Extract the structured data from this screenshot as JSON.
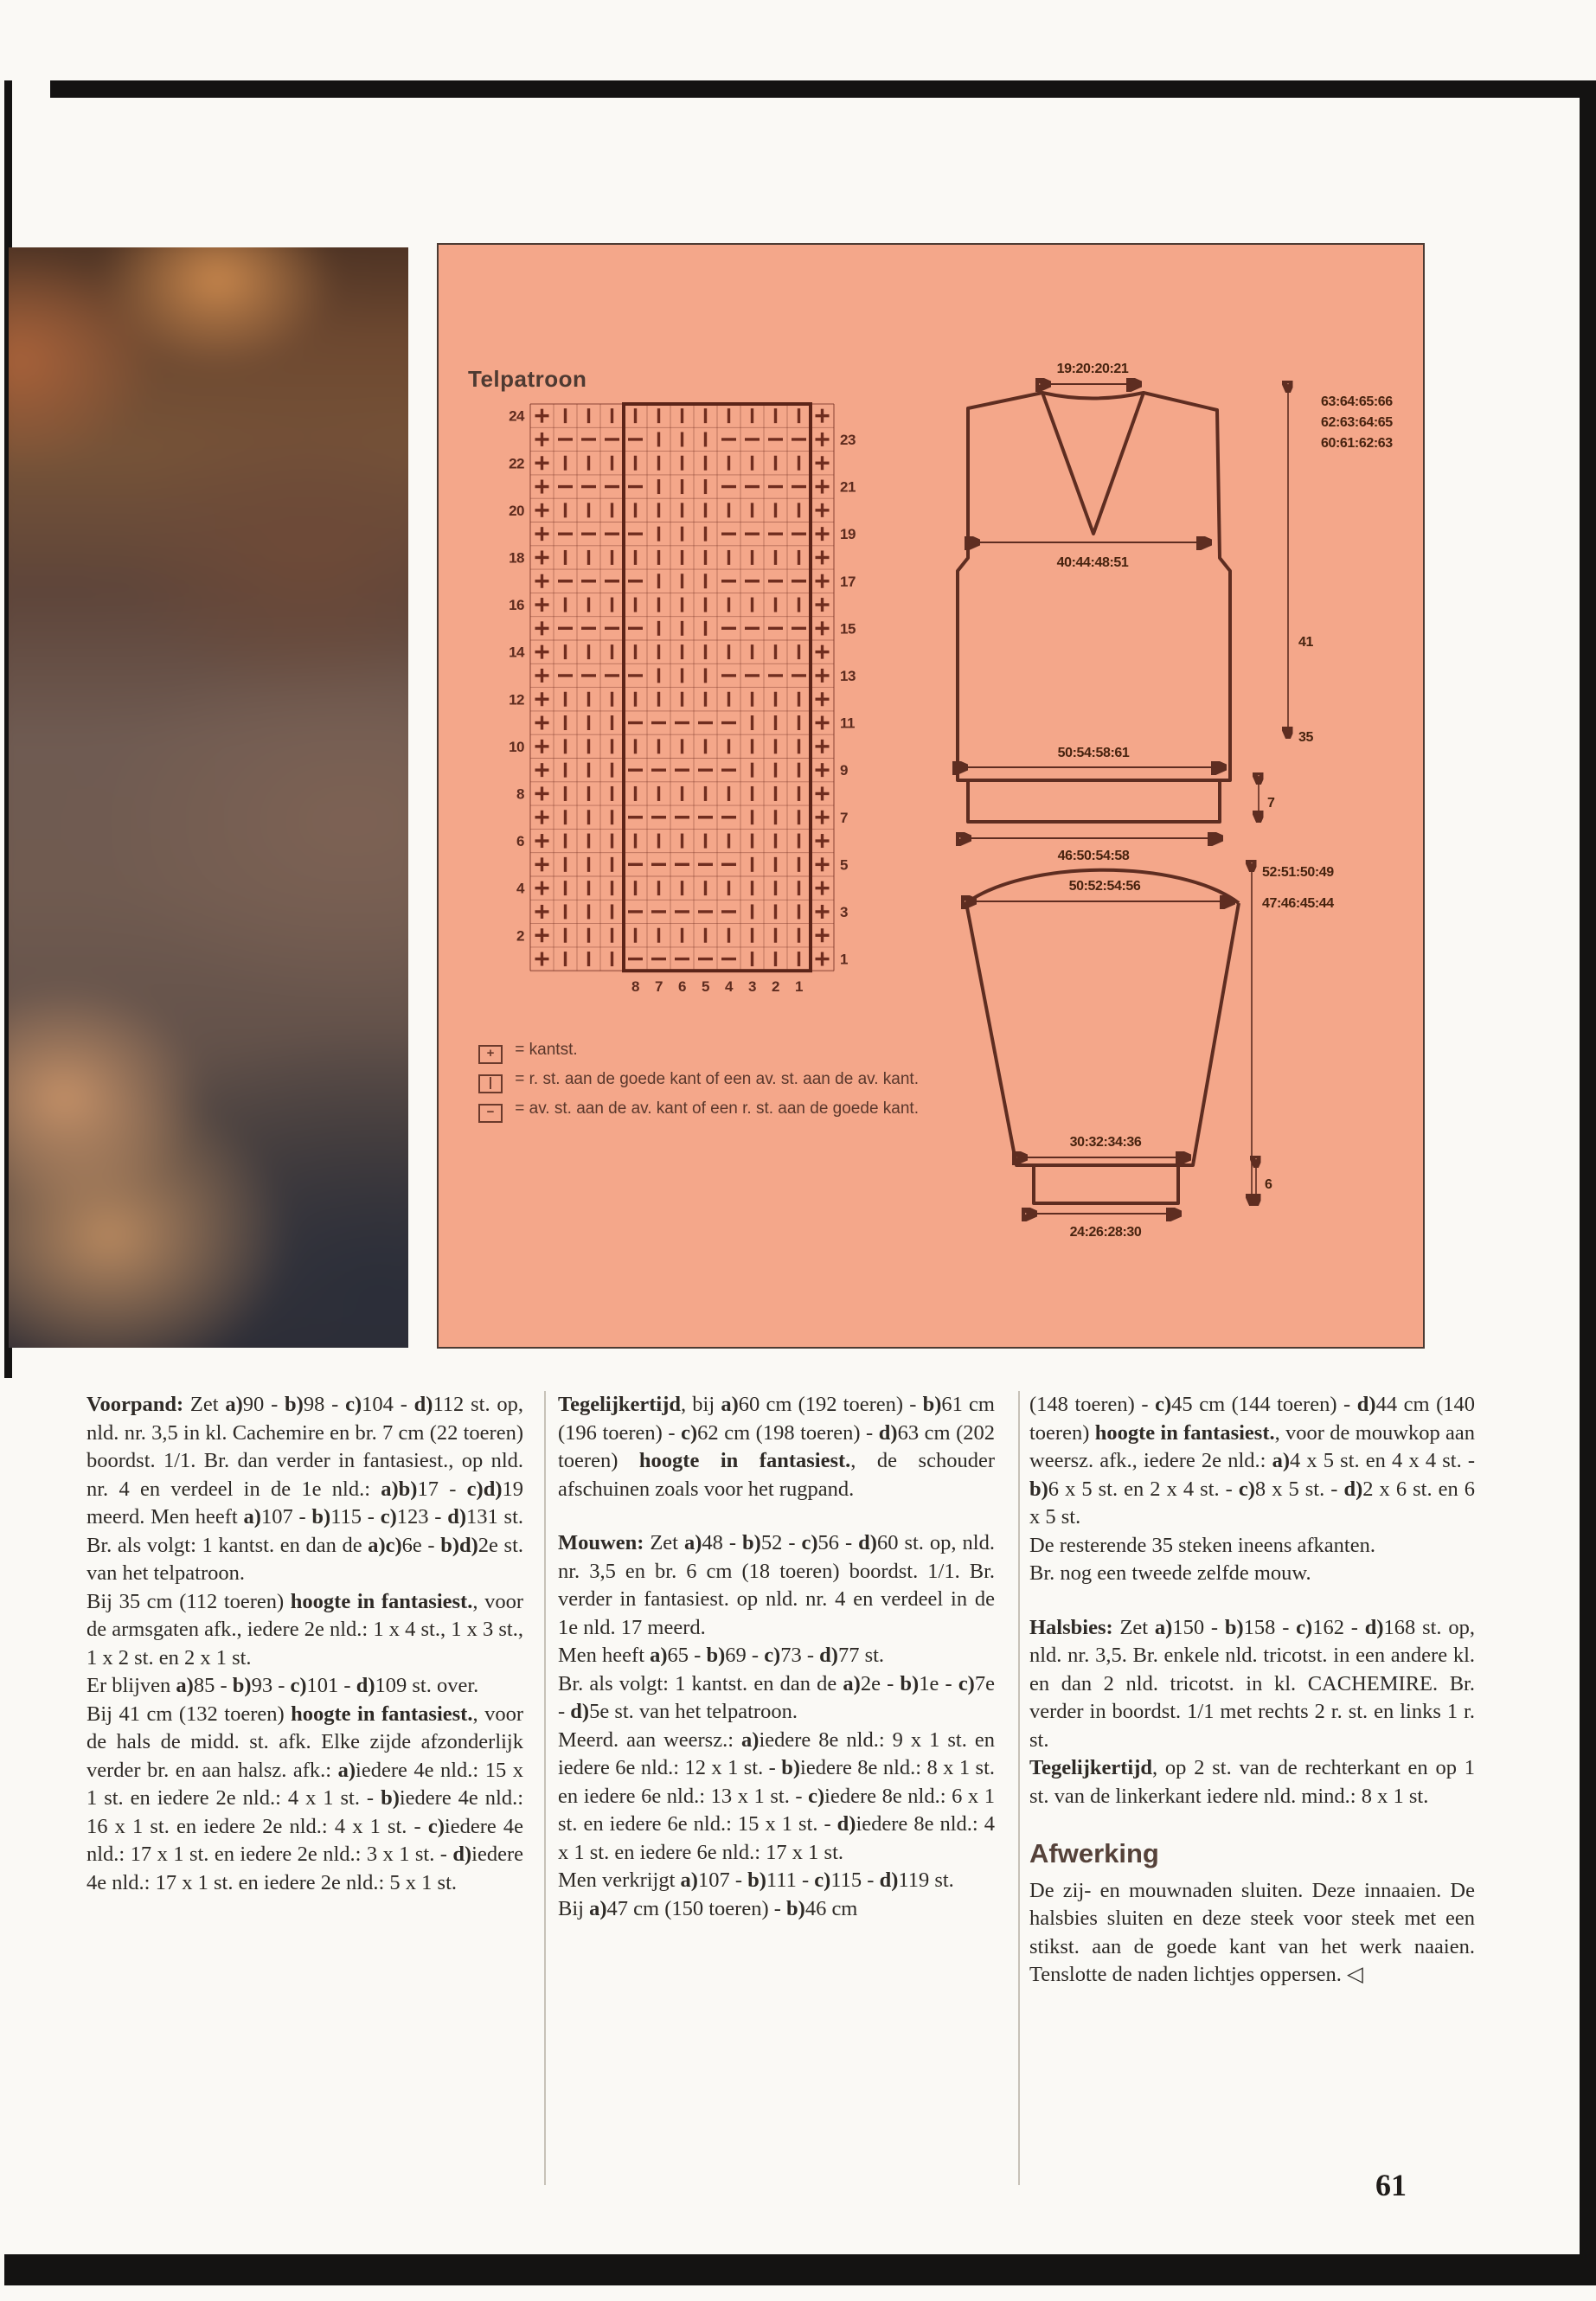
{
  "page": {
    "number": "61"
  },
  "colors": {
    "panel_bg": "#f4a78a",
    "chart_ink": "#6f2d1f",
    "frame_black": "#141312",
    "body_text": "#2e2a26",
    "heading_brown": "#55423a"
  },
  "panel": {
    "chart": {
      "title": "Telpatroon",
      "edge_symbol": "+",
      "bottom_numbers": [
        "8",
        "7",
        "6",
        "5",
        "4",
        "3",
        "2",
        "1"
      ],
      "rows": [
        {
          "n": "24",
          "side": "L",
          "cells": "|||||||||||"
        },
        {
          "n": "23",
          "side": "R",
          "cells": "----|||----"
        },
        {
          "n": "22",
          "side": "L",
          "cells": "|||||||||||"
        },
        {
          "n": "21",
          "side": "R",
          "cells": "----|||----"
        },
        {
          "n": "20",
          "side": "L",
          "cells": "|||||||||||"
        },
        {
          "n": "19",
          "side": "R",
          "cells": "----|||----"
        },
        {
          "n": "18",
          "side": "L",
          "cells": "|||||||||||"
        },
        {
          "n": "17",
          "side": "R",
          "cells": "----|||----"
        },
        {
          "n": "16",
          "side": "L",
          "cells": "|||||||||||"
        },
        {
          "n": "15",
          "side": "R",
          "cells": "----|||----"
        },
        {
          "n": "14",
          "side": "L",
          "cells": "|||||||||||"
        },
        {
          "n": "13",
          "side": "R",
          "cells": "----|||----"
        },
        {
          "n": "12",
          "side": "L",
          "cells": "|||||||||||"
        },
        {
          "n": "11",
          "side": "R",
          "cells": "|||-----|||"
        },
        {
          "n": "10",
          "side": "L",
          "cells": "|||||||||||"
        },
        {
          "n": "9",
          "side": "R",
          "cells": "|||-----|||"
        },
        {
          "n": "8",
          "side": "L",
          "cells": "|||||||||||"
        },
        {
          "n": "7",
          "side": "R",
          "cells": "|||-----|||"
        },
        {
          "n": "6",
          "side": "L",
          "cells": "|||||||||||"
        },
        {
          "n": "5",
          "side": "R",
          "cells": "|||-----|||"
        },
        {
          "n": "4",
          "side": "L",
          "cells": "|||||||||||"
        },
        {
          "n": "3",
          "side": "R",
          "cells": "|||-----|||"
        },
        {
          "n": "2",
          "side": "L",
          "cells": "|||||||||||"
        },
        {
          "n": "1",
          "side": "R",
          "cells": "|||-----|||"
        }
      ]
    },
    "legend": {
      "items": [
        {
          "symbol": "+",
          "text": "= kantst."
        },
        {
          "symbol": "|",
          "text": "= r. st. aan de goede kant of een av. st. aan de av. kant."
        },
        {
          "symbol": "−",
          "text": "= av. st. aan de av. kant of een r. st. aan de goede kant."
        }
      ]
    },
    "body_diagram": {
      "top_width": "19:20:20:21",
      "chest_width": "40:44:48:51",
      "hem_width": "50:54:58:61",
      "rib_width": "46:50:54:58",
      "rib_height": "7",
      "total_heights": "63:64:65:66",
      "mid_heights": "62:63:64:65",
      "low_heights": "60:61:62:63",
      "armhole_height": "41",
      "side_height": "35"
    },
    "sleeve_diagram": {
      "top_width": "50:52:54:56",
      "upper_width": "30:32:34:36",
      "cuff_width": "24:26:28:30",
      "total_length": "52:51:50:49",
      "underarm_length": "47:46:45:44",
      "cuff_height": "6"
    }
  },
  "columns": [
    [
      {
        "style": "p",
        "runs": [
          [
            "b",
            "Voorpand: "
          ],
          [
            "n",
            "Zet "
          ],
          [
            "b",
            "a)"
          ],
          [
            "n",
            "90 - "
          ],
          [
            "b",
            "b)"
          ],
          [
            "n",
            "98 - "
          ],
          [
            "b",
            "c)"
          ],
          [
            "n",
            "104 - "
          ],
          [
            "b",
            "d)"
          ],
          [
            "n",
            "112 st. op, nld. nr. 3,5 in kl. Cachemire en br. 7 cm (22 toeren) boordst. 1/1. Br. dan verder in fantasiest., op nld. nr. 4 en verdeel in de 1e nld.: "
          ],
          [
            "b",
            "a)b)"
          ],
          [
            "n",
            "17 - "
          ],
          [
            "b",
            "c)d)"
          ],
          [
            "n",
            "19 meerd. Men heeft "
          ],
          [
            "b",
            "a)"
          ],
          [
            "n",
            "107 - "
          ],
          [
            "b",
            "b)"
          ],
          [
            "n",
            "115 - "
          ],
          [
            "b",
            "c)"
          ],
          [
            "n",
            "123 - "
          ],
          [
            "b",
            "d)"
          ],
          [
            "n",
            "131 st. Br. als volgt: 1 kantst. en dan de "
          ],
          [
            "b",
            "a)c)"
          ],
          [
            "n",
            "6e - "
          ],
          [
            "b",
            "b)d)"
          ],
          [
            "n",
            "2e st. van het telpatroon."
          ]
        ]
      },
      {
        "style": "p",
        "runs": [
          [
            "n",
            "Bij 35 cm (112 toeren) "
          ],
          [
            "b",
            "hoogte in fantasiest."
          ],
          [
            "n",
            ", voor de armsgaten afk., iedere 2e nld.: 1 x 4 st., 1 x 3 st., 1 x 2 st. en 2 x 1 st."
          ]
        ]
      },
      {
        "style": "p",
        "runs": [
          [
            "n",
            "Er blijven "
          ],
          [
            "b",
            "a)"
          ],
          [
            "n",
            "85 - "
          ],
          [
            "b",
            "b)"
          ],
          [
            "n",
            "93 - "
          ],
          [
            "b",
            "c)"
          ],
          [
            "n",
            "101 - "
          ],
          [
            "b",
            "d)"
          ],
          [
            "n",
            "109 st. over."
          ]
        ]
      },
      {
        "style": "p",
        "runs": [
          [
            "n",
            "Bij 41 cm (132 toeren) "
          ],
          [
            "b",
            "hoogte in fantasiest."
          ],
          [
            "n",
            ", voor de hals de midd. st. afk. Elke zijde afzonderlijk verder br. en aan halsz. afk.: "
          ],
          [
            "b",
            "a)"
          ],
          [
            "n",
            "iedere 4e nld.: 15 x 1 st. en iedere 2e nld.: 4 x 1 st. - "
          ],
          [
            "b",
            "b)"
          ],
          [
            "n",
            "iedere 4e nld.: 16 x 1 st. en iedere 2e nld.: 4 x 1 st. - "
          ],
          [
            "b",
            "c)"
          ],
          [
            "n",
            "iedere 4e nld.: 17 x 1 st. en iedere 2e nld.: 3 x 1 st. - "
          ],
          [
            "b",
            "d)"
          ],
          [
            "n",
            "iedere 4e nld.: 17 x 1 st. en iedere 2e nld.: 5 x 1 st."
          ]
        ]
      }
    ],
    [
      {
        "style": "p",
        "runs": [
          [
            "b",
            "Tegelijkertijd"
          ],
          [
            "n",
            ", bij "
          ],
          [
            "b",
            "a)"
          ],
          [
            "n",
            "60 cm (192 toeren) - "
          ],
          [
            "b",
            "b)"
          ],
          [
            "n",
            "61 cm (196 toeren) - "
          ],
          [
            "b",
            "c)"
          ],
          [
            "n",
            "62 cm (198 toeren) - "
          ],
          [
            "b",
            "d)"
          ],
          [
            "n",
            "63 cm (202 toeren) "
          ],
          [
            "b",
            "hoogte in fantasiest."
          ],
          [
            "n",
            ", de schouder afschuinen zoals voor het rugpand."
          ]
        ]
      },
      {
        "style": "p gap",
        "runs": [
          [
            "b",
            "Mouwen: "
          ],
          [
            "n",
            "Zet "
          ],
          [
            "b",
            "a)"
          ],
          [
            "n",
            "48 - "
          ],
          [
            "b",
            "b)"
          ],
          [
            "n",
            "52 - "
          ],
          [
            "b",
            "c)"
          ],
          [
            "n",
            "56 - "
          ],
          [
            "b",
            "d)"
          ],
          [
            "n",
            "60 st. op, nld. nr. 3,5 en br. 6 cm (18 toeren) boordst. 1/1. Br. verder in fantasiest. op nld. nr. 4 en verdeel in de 1e nld. 17 meerd."
          ]
        ]
      },
      {
        "style": "p",
        "runs": [
          [
            "n",
            "Men heeft "
          ],
          [
            "b",
            "a)"
          ],
          [
            "n",
            "65 - "
          ],
          [
            "b",
            "b)"
          ],
          [
            "n",
            "69 - "
          ],
          [
            "b",
            "c)"
          ],
          [
            "n",
            "73 - "
          ],
          [
            "b",
            "d)"
          ],
          [
            "n",
            "77 st."
          ]
        ]
      },
      {
        "style": "p",
        "runs": [
          [
            "n",
            "Br. als volgt: 1 kantst. en dan de "
          ],
          [
            "b",
            "a)"
          ],
          [
            "n",
            "2e - "
          ],
          [
            "b",
            "b)"
          ],
          [
            "n",
            "1e - "
          ],
          [
            "b",
            "c)"
          ],
          [
            "n",
            "7e - "
          ],
          [
            "b",
            "d)"
          ],
          [
            "n",
            "5e st. van het telpatroon."
          ]
        ]
      },
      {
        "style": "p",
        "runs": [
          [
            "n",
            "Meerd. aan weersz.: "
          ],
          [
            "b",
            "a)"
          ],
          [
            "n",
            "iedere 8e nld.: 9 x 1 st. en iedere 6e nld.: 12 x 1 st. - "
          ],
          [
            "b",
            "b)"
          ],
          [
            "n",
            "iedere 8e nld.: 8 x 1 st. en iedere 6e nld.: 13 x 1 st. - "
          ],
          [
            "b",
            "c)"
          ],
          [
            "n",
            "iedere 8e nld.: 6 x 1 st. en iedere 6e nld.: 15 x 1 st. - "
          ],
          [
            "b",
            "d)"
          ],
          [
            "n",
            "iedere 8e nld.: 4 x 1 st. en iedere 6e nld.: 17 x 1 st."
          ]
        ]
      },
      {
        "style": "p",
        "runs": [
          [
            "n",
            "Men verkrijgt "
          ],
          [
            "b",
            "a)"
          ],
          [
            "n",
            "107 - "
          ],
          [
            "b",
            "b)"
          ],
          [
            "n",
            "111 - "
          ],
          [
            "b",
            "c)"
          ],
          [
            "n",
            "115 - "
          ],
          [
            "b",
            "d)"
          ],
          [
            "n",
            "119 st."
          ]
        ]
      },
      {
        "style": "p",
        "runs": [
          [
            "n",
            "Bij "
          ],
          [
            "b",
            "a)"
          ],
          [
            "n",
            "47 cm (150 toeren) - "
          ],
          [
            "b",
            "b)"
          ],
          [
            "n",
            "46 cm"
          ]
        ]
      }
    ],
    [
      {
        "style": "p",
        "runs": [
          [
            "n",
            "(148 toeren) - "
          ],
          [
            "b",
            "c)"
          ],
          [
            "n",
            "45 cm (144 toeren) - "
          ],
          [
            "b",
            "d)"
          ],
          [
            "n",
            "44 cm (140 toeren) "
          ],
          [
            "b",
            "hoogte in fantasiest."
          ],
          [
            "n",
            ", voor de mouwkop aan weersz. afk., iedere 2e nld.: "
          ],
          [
            "b",
            "a)"
          ],
          [
            "n",
            "4 x 5 st. en 4 x 4 st. - "
          ],
          [
            "b",
            "b)"
          ],
          [
            "n",
            "6 x 5 st. en 2 x 4 st. - "
          ],
          [
            "b",
            "c)"
          ],
          [
            "n",
            "8 x 5 st. - "
          ],
          [
            "b",
            "d)"
          ],
          [
            "n",
            "2 x 6 st. en 6 x 5 st."
          ]
        ]
      },
      {
        "style": "p",
        "runs": [
          [
            "n",
            "De resterende 35 steken ineens afkanten."
          ]
        ]
      },
      {
        "style": "p",
        "runs": [
          [
            "n",
            "Br. nog een tweede zelfde mouw."
          ]
        ]
      },
      {
        "style": "p gap",
        "runs": [
          [
            "b",
            "Halsbies: "
          ],
          [
            "n",
            "Zet "
          ],
          [
            "b",
            "a)"
          ],
          [
            "n",
            "150 - "
          ],
          [
            "b",
            "b)"
          ],
          [
            "n",
            "158 - "
          ],
          [
            "b",
            "c)"
          ],
          [
            "n",
            "162 - "
          ],
          [
            "b",
            "d)"
          ],
          [
            "n",
            "168 st. op, nld. nr. 3,5. Br. enkele nld. tricotst. in een andere kl. en dan 2 nld. tricotst. in kl. CACHEMIRE. Br. verder in boordst. 1/1 met rechts 2 r. st. en links 1 r. st."
          ]
        ]
      },
      {
        "style": "p",
        "runs": [
          [
            "b",
            "Tegelijkertijd"
          ],
          [
            "n",
            ", op 2 st. van de rechterkant en op 1 st. van de linkerkant iedere nld. mind.: 8 x 1 st."
          ]
        ]
      },
      {
        "style": "h",
        "runs": [
          [
            "b",
            "Afwerking"
          ]
        ]
      },
      {
        "style": "p",
        "runs": [
          [
            "n",
            "De zij- en mouwnaden sluiten. Deze innaaien. De halsbies sluiten en deze steek voor steek met een stikst. aan de goede kant van het werk naaien. Tenslotte de naden lichtjes oppersen. ◁"
          ]
        ]
      }
    ]
  ]
}
